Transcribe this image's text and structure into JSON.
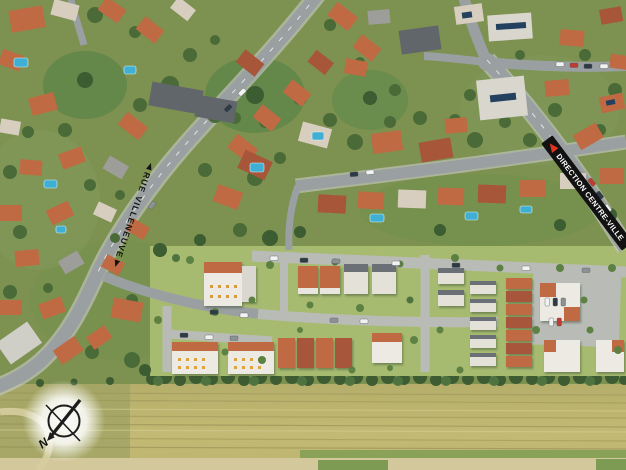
{
  "meta": {
    "view": "aerial-photo-site-plan",
    "description_visible_elements": "aerial view of suburban neighborhood, new housing development render, crop field, street labels, compass rose"
  },
  "labels": {
    "street": {
      "text": "RUE VILLENEUVE"
    },
    "direction": {
      "text": "DIRECTION CENTRE-VILLE"
    },
    "compass_north": "N"
  },
  "icons": {
    "compass": "compass-rose-icon",
    "direction_arrow": "red-arrow-icon",
    "street_arrows": "black-arrowhead-icons"
  },
  "colors": {
    "asphalt": "#9aa0a2",
    "curb": "#c6c8c2",
    "dev_road": "#b9bcb6",
    "grass": "#7d9150",
    "tree": "#4a6b38",
    "tree_dark": "#3c5c31",
    "dev_lawn": "#a7bb70",
    "roof_orange": "#bf6a42",
    "roof_dark_orange": "#a8563a",
    "roof_tan": "#d8cec0",
    "roof_gray": "#9d9d99",
    "roof_slate": "#61666a",
    "building_white": "#eceae2",
    "pool": "#3fb0d4",
    "field": "#bcb46f",
    "field_line": "#9a9457",
    "field_line_light": "#d6cf92",
    "hedge": "#3d5c32",
    "banner": "#121212",
    "banner_text": "#ffffff",
    "arrow_red": "#e23222",
    "label_black": "#141414",
    "path_tan": "#d2c89b",
    "solar_panel": "#24405f",
    "car_dark": "#2e3a45",
    "car_white": "#f2f2f2",
    "car_red": "#c23b32"
  }
}
